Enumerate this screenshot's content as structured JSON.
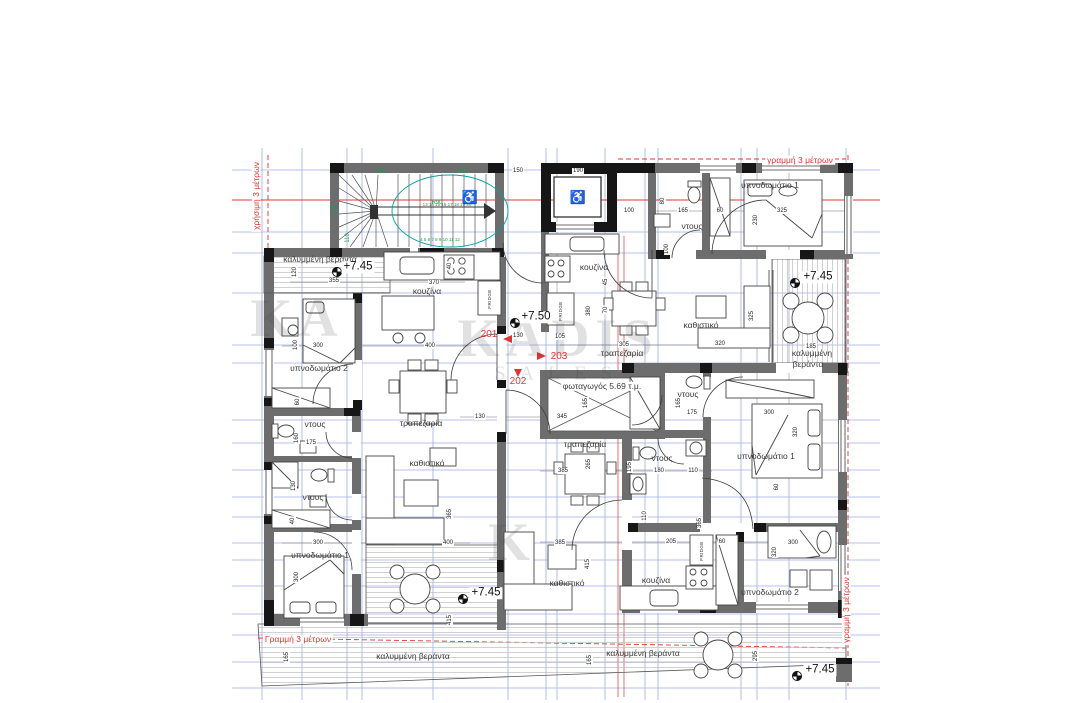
{
  "watermark": {
    "main": "KADIS",
    "sub": "SALES",
    "partial_left": "KA",
    "partial_bottom": "K"
  },
  "guide_labels": [
    {
      "text": "χρήσιμη 3 μέτρων",
      "x": 256,
      "y": 196,
      "rot": -90
    },
    {
      "text": "γραμμή 3 μέτρων",
      "x": 800,
      "y": 160,
      "rot": 0
    },
    {
      "text": "Γραμμή 3 μέτρων",
      "x": 298,
      "y": 639,
      "rot": 0
    },
    {
      "text": "γραμμή 3 μέτρων",
      "x": 846,
      "y": 610,
      "rot": -90
    }
  ],
  "unit_labels": [
    {
      "text": "201",
      "x": 489,
      "y": 335
    },
    {
      "text": "203",
      "x": 559,
      "y": 357
    },
    {
      "text": "202",
      "x": 518,
      "y": 382
    }
  ],
  "level_markers": [
    {
      "text": "+7.45",
      "x": 358,
      "y": 267
    },
    {
      "text": "+7.50",
      "x": 536,
      "y": 317
    },
    {
      "text": "+7.45",
      "x": 818,
      "y": 277
    },
    {
      "text": "+7.45",
      "x": 486,
      "y": 593
    },
    {
      "text": "+7.45",
      "x": 820,
      "y": 670
    }
  ],
  "room_labels": [
    {
      "text": "καλυμμένη βεράντα",
      "x": 320,
      "y": 259
    },
    {
      "text": "κουζίνα",
      "x": 427,
      "y": 291
    },
    {
      "text": "υπνοδωμάτιο 2",
      "x": 319,
      "y": 368
    },
    {
      "text": "ντους",
      "x": 315,
      "y": 424
    },
    {
      "text": "ντους",
      "x": 313,
      "y": 497
    },
    {
      "text": "υπνοδωμάτιο 1",
      "x": 320,
      "y": 555
    },
    {
      "text": "τραπεζαρία",
      "x": 421,
      "y": 423
    },
    {
      "text": "καθιστικό",
      "x": 427,
      "y": 463
    },
    {
      "text": "κουζίνα",
      "x": 594,
      "y": 267
    },
    {
      "text": "τραπεζαρία",
      "x": 622,
      "y": 353
    },
    {
      "text": "καθιστικό",
      "x": 701,
      "y": 325
    },
    {
      "text": "υπνοδωμάτιο 1",
      "x": 770,
      "y": 185
    },
    {
      "text": "ντους",
      "x": 692,
      "y": 226
    },
    {
      "text": "καλυμμένη",
      "x": 812,
      "y": 353
    },
    {
      "text": "βεράντα",
      "x": 808,
      "y": 364
    },
    {
      "text": "φωταγωγός 5.69 τ.μ.",
      "x": 602,
      "y": 386,
      "chip": true
    },
    {
      "text": "τραπεζαρία",
      "x": 585,
      "y": 444
    },
    {
      "text": "ντους",
      "x": 688,
      "y": 394
    },
    {
      "text": "ντους",
      "x": 662,
      "y": 458
    },
    {
      "text": "υπνοδωμάτιο 1",
      "x": 766,
      "y": 456
    },
    {
      "text": "καθιστικό",
      "x": 567,
      "y": 583
    },
    {
      "text": "κουζίνα",
      "x": 656,
      "y": 580
    },
    {
      "text": "υπνοδωμάτιο 2",
      "x": 770,
      "y": 592
    },
    {
      "text": "καλυμμένη βεράντα",
      "x": 413,
      "y": 656
    },
    {
      "text": "καλυμμένη βεράντα",
      "x": 643,
      "y": 653
    }
  ],
  "dimension_labels": [
    {
      "text": "150",
      "x": 518,
      "y": 171
    },
    {
      "text": "190",
      "x": 578,
      "y": 171
    },
    {
      "text": "100",
      "x": 629,
      "y": 211
    },
    {
      "text": "80",
      "x": 663,
      "y": 201,
      "rot": -90
    },
    {
      "text": "100",
      "x": 667,
      "y": 249,
      "rot": -90
    },
    {
      "text": "165",
      "x": 683,
      "y": 211
    },
    {
      "text": "60",
      "x": 720,
      "y": 211
    },
    {
      "text": "325",
      "x": 782,
      "y": 211
    },
    {
      "text": "230",
      "x": 756,
      "y": 220,
      "rot": -90
    },
    {
      "text": "355",
      "x": 334,
      "y": 281
    },
    {
      "text": "120",
      "x": 295,
      "y": 272,
      "rot": -90
    },
    {
      "text": "370",
      "x": 434,
      "y": 283
    },
    {
      "text": "40",
      "x": 450,
      "y": 266,
      "rot": -90
    },
    {
      "text": "45",
      "x": 606,
      "y": 282,
      "rot": -90
    },
    {
      "text": "70",
      "x": 606,
      "y": 310,
      "rot": -90
    },
    {
      "text": "380",
      "x": 589,
      "y": 311,
      "rot": -90
    },
    {
      "text": "100",
      "x": 296,
      "y": 345,
      "rot": -90
    },
    {
      "text": "300",
      "x": 318,
      "y": 346
    },
    {
      "text": "400",
      "x": 430,
      "y": 346
    },
    {
      "text": "130",
      "x": 518,
      "y": 336
    },
    {
      "text": "105",
      "x": 560,
      "y": 337
    },
    {
      "text": "305",
      "x": 624,
      "y": 345
    },
    {
      "text": "320",
      "x": 720,
      "y": 344
    },
    {
      "text": "325",
      "x": 752,
      "y": 316,
      "rot": -90
    },
    {
      "text": "185",
      "x": 811,
      "y": 347
    },
    {
      "text": "130",
      "x": 480,
      "y": 417
    },
    {
      "text": "345",
      "x": 562,
      "y": 417
    },
    {
      "text": "165",
      "x": 586,
      "y": 403,
      "rot": -90
    },
    {
      "text": "160",
      "x": 297,
      "y": 438,
      "rot": -90
    },
    {
      "text": "175",
      "x": 311,
      "y": 443
    },
    {
      "text": "60",
      "x": 298,
      "y": 402,
      "rot": -90
    },
    {
      "text": "130",
      "x": 294,
      "y": 486,
      "rot": -90
    },
    {
      "text": "40",
      "x": 293,
      "y": 521,
      "rot": -90
    },
    {
      "text": "300",
      "x": 318,
      "y": 543
    },
    {
      "text": "400",
      "x": 448,
      "y": 543
    },
    {
      "text": "365",
      "x": 450,
      "y": 514,
      "rot": -90
    },
    {
      "text": "415",
      "x": 450,
      "y": 620,
      "rot": -90
    },
    {
      "text": "300",
      "x": 297,
      "y": 577,
      "rot": -90
    },
    {
      "text": "195",
      "x": 630,
      "y": 467,
      "rot": -90
    },
    {
      "text": "180",
      "x": 659,
      "y": 471
    },
    {
      "text": "110",
      "x": 693,
      "y": 471
    },
    {
      "text": "110",
      "x": 645,
      "y": 516,
      "rot": -90
    },
    {
      "text": "385",
      "x": 563,
      "y": 471
    },
    {
      "text": "265",
      "x": 589,
      "y": 464,
      "rot": -90
    },
    {
      "text": "175",
      "x": 692,
      "y": 413
    },
    {
      "text": "165",
      "x": 679,
      "y": 403,
      "rot": -90
    },
    {
      "text": "300",
      "x": 769,
      "y": 413
    },
    {
      "text": "320",
      "x": 796,
      "y": 432,
      "rot": -90
    },
    {
      "text": "60",
      "x": 777,
      "y": 487,
      "rot": -90
    },
    {
      "text": "385",
      "x": 560,
      "y": 543
    },
    {
      "text": "205",
      "x": 671,
      "y": 542
    },
    {
      "text": "60",
      "x": 722,
      "y": 542
    },
    {
      "text": "300",
      "x": 793,
      "y": 543
    },
    {
      "text": "320",
      "x": 775,
      "y": 552,
      "rot": -90
    },
    {
      "text": "415",
      "x": 588,
      "y": 564,
      "rot": -90
    },
    {
      "text": "365",
      "x": 700,
      "y": 523,
      "rot": -90
    },
    {
      "text": "165",
      "x": 287,
      "y": 657,
      "rot": -90
    },
    {
      "text": "165",
      "x": 590,
      "y": 660,
      "rot": -90
    },
    {
      "text": "295",
      "x": 756,
      "y": 656,
      "rot": -90
    }
  ],
  "stair_annotations": [
    {
      "text": "310",
      "x": 381,
      "y": 172
    },
    {
      "text": "185",
      "x": 462,
      "y": 172
    },
    {
      "text": "R90",
      "x": 437,
      "y": 203
    },
    {
      "text": "110",
      "x": 336,
      "y": 211,
      "rot": -90
    },
    {
      "text": "110",
      "x": 348,
      "y": 238,
      "rot": -90
    },
    {
      "text": "13 14 15 16 17 18 19 20",
      "x": 447,
      "y": 205,
      "size": 4.5
    },
    {
      "text": "4 5 6 7 8 9 10 11 12",
      "x": 440,
      "y": 240,
      "size": 4.5
    },
    {
      "text": "♿",
      "x": 470,
      "y": 197,
      "size": 13
    }
  ],
  "fixture_labels": [
    {
      "text": "FRIDGE",
      "x": 490,
      "y": 299,
      "rot": -90
    },
    {
      "text": "FRIDGE",
      "x": 561,
      "y": 311,
      "rot": -90
    },
    {
      "text": "FRIDGE",
      "x": 702,
      "y": 551,
      "rot": -90
    },
    {
      "text": "♿",
      "x": 578,
      "y": 197,
      "size": 13
    }
  ]
}
